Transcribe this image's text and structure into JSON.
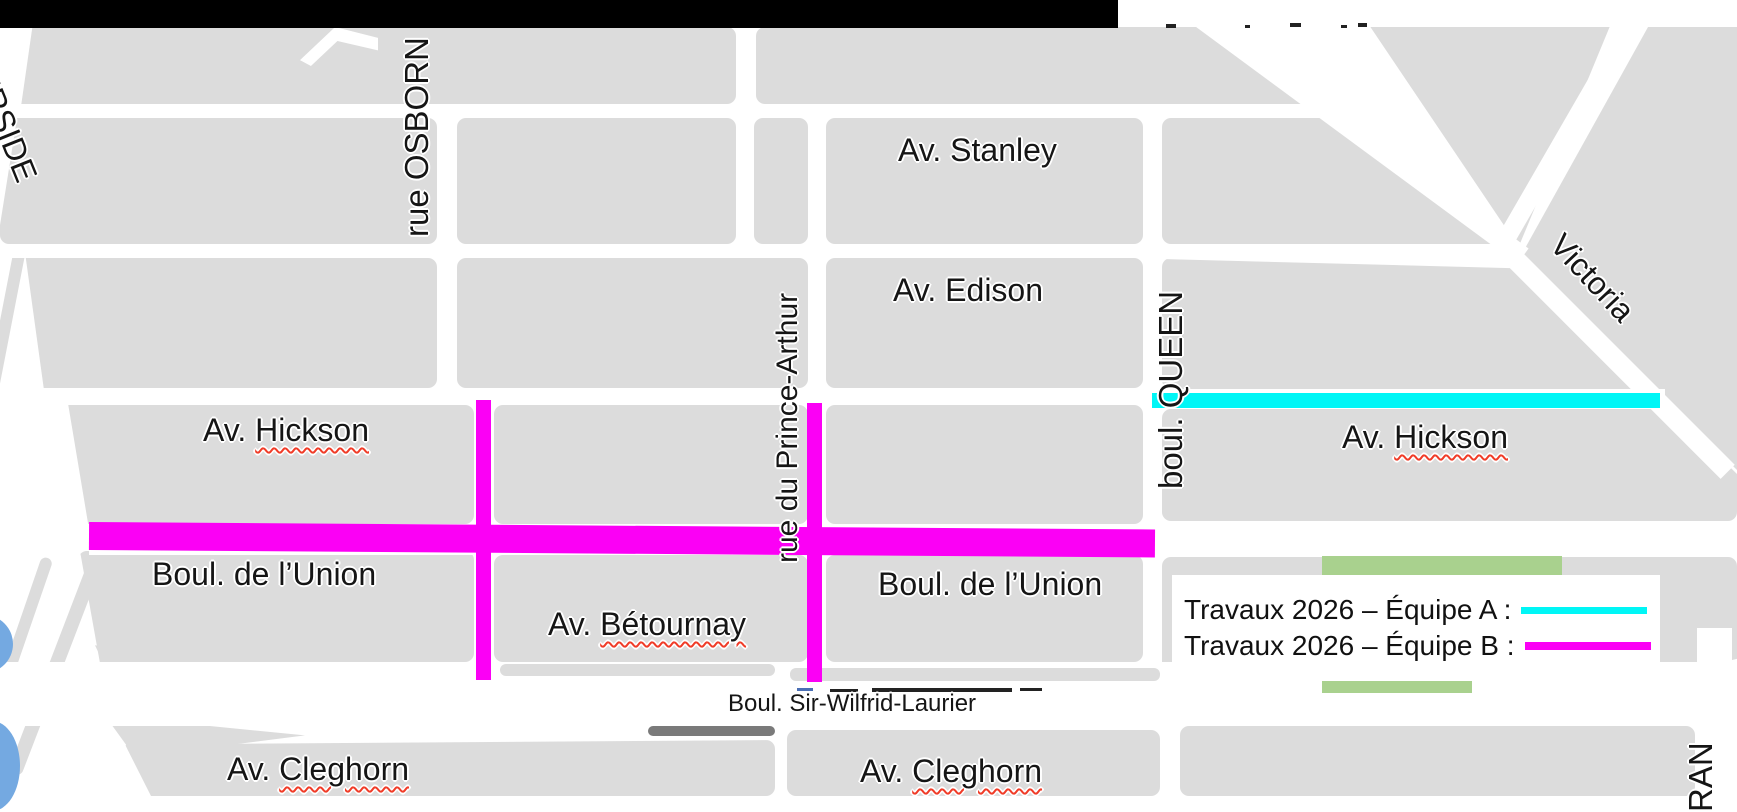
{
  "map": {
    "streets": {
      "riverside": {
        "name": "VERSIDE"
      },
      "osborn": {
        "name": "rue OSBORN"
      },
      "stanley": {
        "name": "Av. Stanley"
      },
      "edison": {
        "name": "Av. Edison"
      },
      "prince_arthur": {
        "name": "rue du Prince-Arthur"
      },
      "queen": {
        "name": "boul. QUEEN"
      },
      "victoria": {
        "name": "Victoria"
      },
      "hickson_left": {
        "prefix": "Av. ",
        "word": "Hickson"
      },
      "hickson_right": {
        "prefix": "Av. ",
        "word": "Hickson"
      },
      "union_left": {
        "name": "Boul. de l’Union"
      },
      "union_right": {
        "name": "Boul. de l’Union"
      },
      "betournay": {
        "prefix": "Av. ",
        "word": "Bétournay"
      },
      "laurier": {
        "name": "Boul. Sir-Wilfrid-Laurier"
      },
      "cleghorn_left": {
        "prefix": "Av. ",
        "word": "Cleghorn"
      },
      "cleghorn_right": {
        "prefix": "Av. ",
        "word": "Cleghorn"
      },
      "ran": {
        "name": "RAN"
      }
    },
    "colors": {
      "block_gray": "#dcdcdc",
      "street_white": "#ffffff",
      "team_a_cyan": "#00f6f6",
      "team_b_magenta": "#fb00f5",
      "park_green": "#a9d18e",
      "water_blue": "#74a9e1",
      "title_bar_black": "#000000",
      "spellcheck_red": "#f03c28"
    }
  },
  "legend": {
    "rows": [
      {
        "label": "Travaux 2026 – Équipe A :",
        "color": "#00f6f6"
      },
      {
        "label": "Travaux 2026 – Équipe B :",
        "color": "#fb00f5"
      }
    ]
  }
}
